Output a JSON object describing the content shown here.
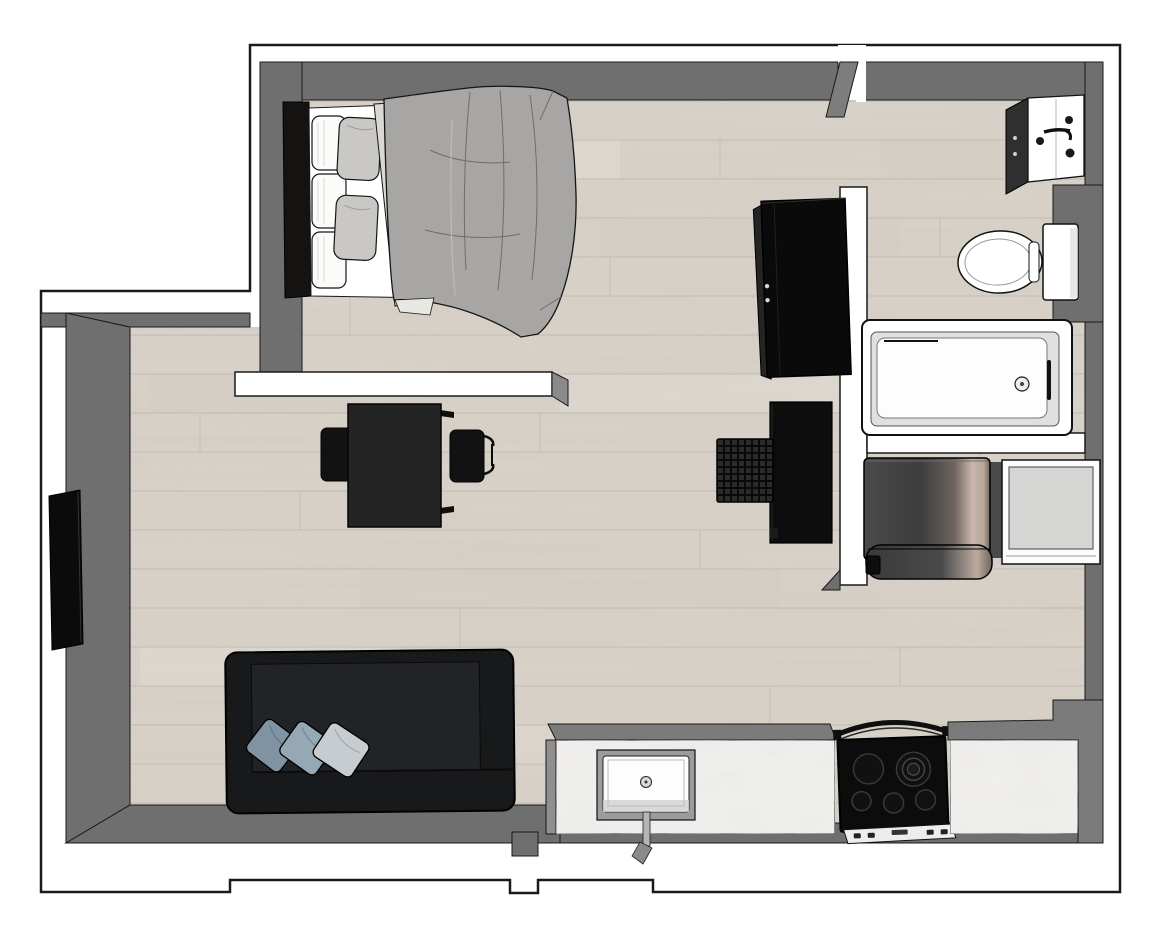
{
  "scene": {
    "type": "3d-floorplan-top-down-render",
    "subject": "studio apartment",
    "background": "#ffffff",
    "has_text": false
  },
  "colors": {
    "outline": "#1a1a1a",
    "floor": "#d9d3ca",
    "floor_line": "#bdb7ae",
    "floor_streak_light": "#e4ded6",
    "floor_streak_dark": "#cfc9c0",
    "wall_face": "#6f6f6f",
    "wall_face_light": "#7d7d7d",
    "wall_top": "#ffffff",
    "black_furniture": "#131313",
    "sofa": "#18191b",
    "sofa_seat": "#222326",
    "cushion_blue_1": "#7f93a3",
    "cushion_blue_2": "#96a8b4",
    "cushion_gray": "#c7ccd0",
    "duvet": "#a7a6a4",
    "duvet_fold": "#6e6d6b",
    "sheet": "#d9d8d2",
    "pillow_white": "#fbfbfa",
    "pillow_gray": "#c9c8c5",
    "marble": "#f1f0ee",
    "counter_edge": "#7b7b7b",
    "appliance_light": "#d5d5d3",
    "washer_dark": "#404040",
    "washer_highlight": "#c9b6ab",
    "fixture": "#ffffff",
    "basket": "#2b2b2b"
  },
  "rooms": [
    {
      "name": "bedroom",
      "furniture": [
        "double-bed"
      ]
    },
    {
      "name": "living-area",
      "furniture": [
        "sofa",
        "cushions",
        "tv",
        "table",
        "chair-left",
        "chair-right",
        "wardrobe",
        "side-cabinet",
        "woven-basket"
      ]
    },
    {
      "name": "bathroom",
      "furniture": [
        "vanity-sink",
        "toilet",
        "bathtub"
      ]
    },
    {
      "name": "laundry",
      "furniture": [
        "washing-machine",
        "dryer"
      ]
    },
    {
      "name": "kitchen",
      "furniture": [
        "counter-left",
        "kitchen-sink",
        "stove",
        "counter-right"
      ]
    }
  ],
  "objects": {
    "bed": {
      "label": "Double bed with gray duvet and pillows"
    },
    "wardrobe": {
      "label": "Black wardrobe"
    },
    "tv": {
      "label": "Wall-mounted TV"
    },
    "table": {
      "label": "Dining / work table"
    },
    "chair_left": {
      "label": "Chair"
    },
    "chair_right": {
      "label": "Armchair"
    },
    "side_cabinet": {
      "label": "Side cabinet"
    },
    "basket": {
      "label": "Woven basket"
    },
    "sofa": {
      "label": "Dark sofa with three cushions"
    },
    "washer": {
      "label": "Washing machine"
    },
    "dryer": {
      "label": "Dryer / appliance"
    },
    "counter_left": {
      "label": "Marble kitchen counter with sink"
    },
    "kitchen_sink": {
      "label": "Kitchen sink with faucet"
    },
    "stove": {
      "label": "Five-burner stove"
    },
    "counter_right": {
      "label": "Marble kitchen counter"
    },
    "vanity": {
      "label": "Bathroom vanity sink"
    },
    "toilet": {
      "label": "Toilet"
    },
    "bathtub": {
      "label": "Bathtub"
    }
  }
}
